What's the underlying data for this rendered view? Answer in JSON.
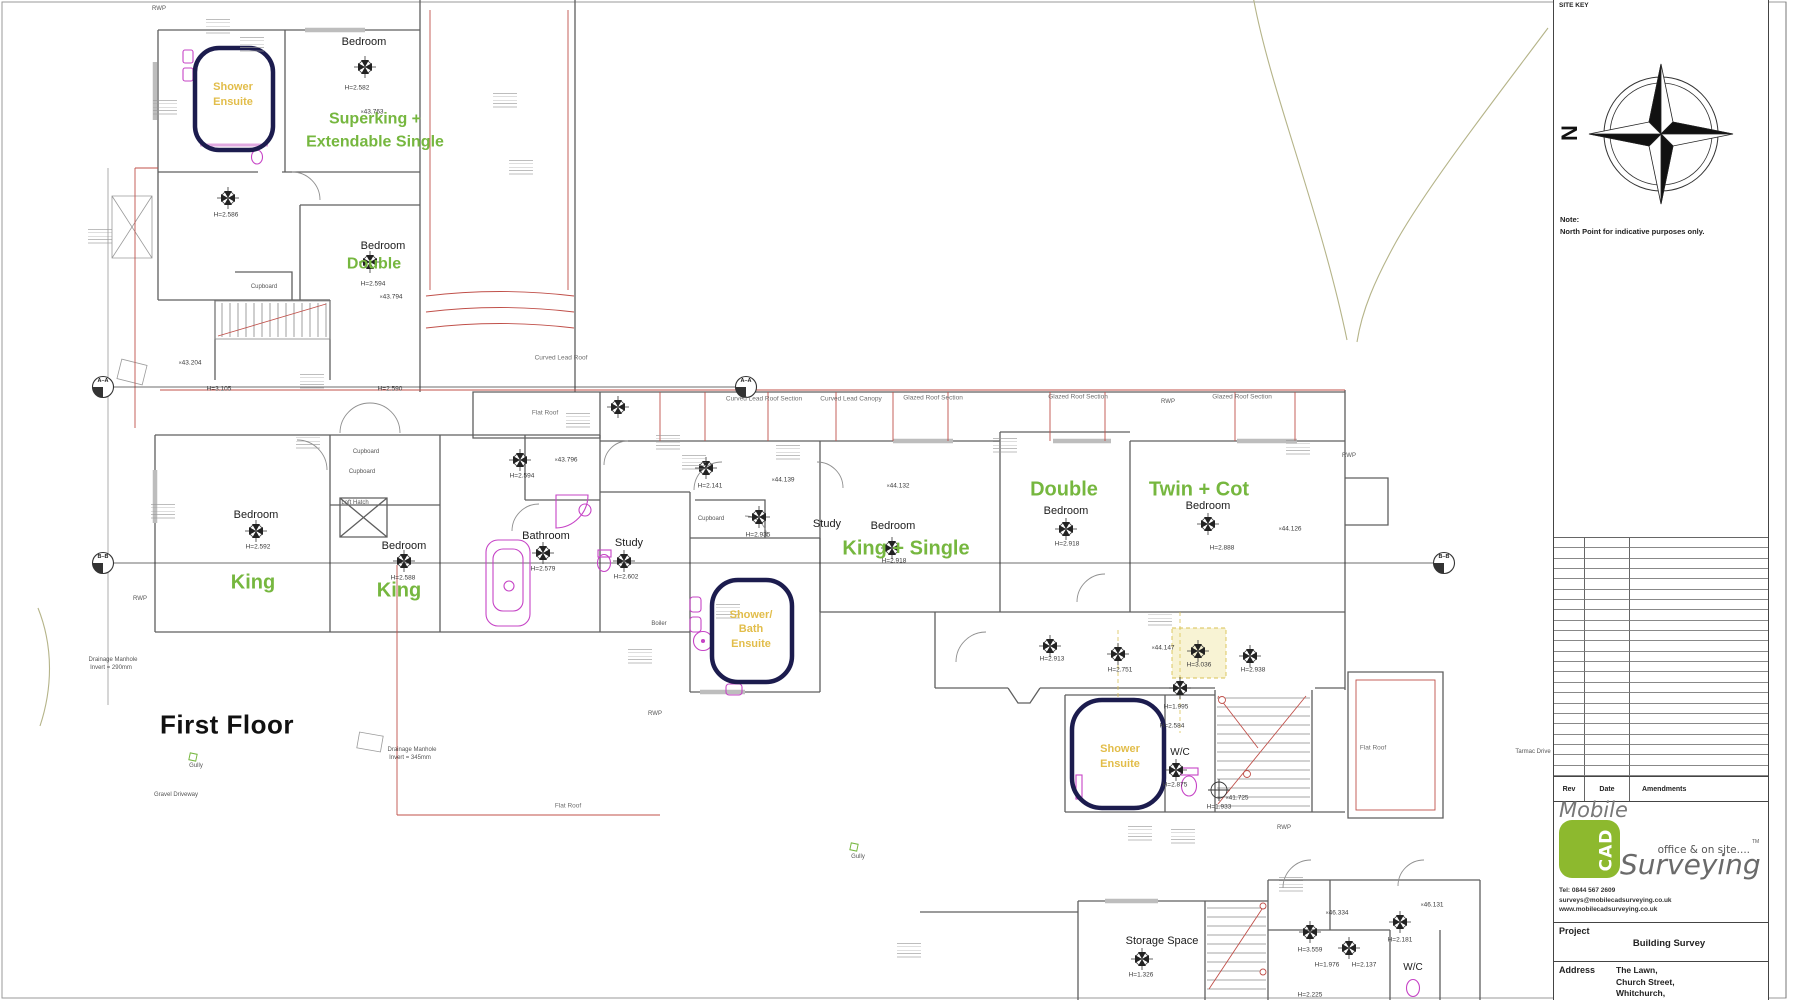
{
  "colors": {
    "room_type_green": "#76b73f",
    "ensuite_yellow": "#e2bd4a",
    "shower_outline_navy": "#1c1c4e",
    "fixture_magenta": "#c644c6",
    "roof_line_red": "#c0504a",
    "logo_green": "#8db92e"
  },
  "sheet": {
    "site_key_label": "SITE KEY",
    "north_letter": "N",
    "note_title": "Note:",
    "note_body": "North Point for indicative purposes only."
  },
  "title_block": {
    "rev_headers": [
      "Rev",
      "Date",
      "Amendments"
    ],
    "empty_rev_rows": 23,
    "logo_mobile": "Mobile",
    "logo_cad": "CAD",
    "logo_surveying": "Surveying",
    "logo_tagline": "office & on site....",
    "logo_tm": "TM",
    "contact_lines": [
      "Tel: 0844 567 2609",
      "surveys@mobilecadsurveying.co.uk",
      "www.mobilecadsurveying.co.uk"
    ],
    "project_label": "Project",
    "project_value": "Building Survey",
    "address_label": "Address",
    "address_lines": [
      "The Lawn,",
      "Church Street,",
      "Whitchurch,"
    ]
  },
  "plan": {
    "floor_title": "First Floor",
    "labels": [
      {
        "t": "Bedroom",
        "x": 364,
        "y": 43,
        "c": "room"
      },
      {
        "t": "Bedroom",
        "x": 383,
        "y": 247,
        "c": "room"
      },
      {
        "t": "Bedroom",
        "x": 256,
        "y": 516,
        "c": "room"
      },
      {
        "t": "Bedroom",
        "x": 404,
        "y": 547,
        "c": "room"
      },
      {
        "t": "Bathroom",
        "x": 546,
        "y": 537,
        "c": "room"
      },
      {
        "t": "Study",
        "x": 629,
        "y": 544,
        "c": "room"
      },
      {
        "t": "Study",
        "x": 827,
        "y": 525,
        "c": "room"
      },
      {
        "t": "Bedroom",
        "x": 893,
        "y": 527,
        "c": "room"
      },
      {
        "t": "Bedroom",
        "x": 1066,
        "y": 512,
        "c": "room"
      },
      {
        "t": "Bedroom",
        "x": 1208,
        "y": 507,
        "c": "room"
      },
      {
        "t": "Storage Space",
        "x": 1162,
        "y": 942,
        "c": "room"
      },
      {
        "t": "W/C",
        "x": 1180,
        "y": 753,
        "c": "wc"
      },
      {
        "t": "W/C",
        "x": 1413,
        "y": 968,
        "c": "wc"
      },
      {
        "t": "Superking +",
        "x": 375,
        "y": 120,
        "c": "g17"
      },
      {
        "t": "Extendable Single",
        "x": 375,
        "y": 143,
        "c": "g17"
      },
      {
        "t": "Double",
        "x": 374,
        "y": 265,
        "c": "g17"
      },
      {
        "t": "King",
        "x": 253,
        "y": 583,
        "c": "g20"
      },
      {
        "t": "King",
        "x": 399,
        "y": 591,
        "c": "g20"
      },
      {
        "t": "King + Single",
        "x": 906,
        "y": 549,
        "c": "g20"
      },
      {
        "t": "Double",
        "x": 1064,
        "y": 490,
        "c": "g20"
      },
      {
        "t": "Twin + Cot",
        "x": 1199,
        "y": 490,
        "c": "g20"
      },
      {
        "t": "Shower",
        "x": 233,
        "y": 88,
        "c": "yel"
      },
      {
        "t": "Ensuite",
        "x": 233,
        "y": 103,
        "c": "yel"
      },
      {
        "t": "Shower/",
        "x": 751,
        "y": 616,
        "c": "yel"
      },
      {
        "t": "Bath",
        "x": 751,
        "y": 630,
        "c": "yel"
      },
      {
        "t": "Ensuite",
        "x": 751,
        "y": 645,
        "c": "yel"
      },
      {
        "t": "Shower",
        "x": 1120,
        "y": 750,
        "c": "yel"
      },
      {
        "t": "Ensuite",
        "x": 1120,
        "y": 765,
        "c": "yel"
      },
      {
        "t": "H=2.582",
        "x": 357,
        "y": 89,
        "c": "meas"
      },
      {
        "t": "H=2.586",
        "x": 226,
        "y": 216,
        "c": "meas"
      },
      {
        "t": "H=2.594",
        "x": 373,
        "y": 285,
        "c": "meas"
      },
      {
        "t": "H=3.105",
        "x": 219,
        "y": 390,
        "c": "meas"
      },
      {
        "t": "H=2.590",
        "x": 390,
        "y": 390,
        "c": "meas"
      },
      {
        "t": "H=2.592",
        "x": 258,
        "y": 548,
        "c": "meas"
      },
      {
        "t": "H=2.588",
        "x": 403,
        "y": 579,
        "c": "meas"
      },
      {
        "t": "H=2.579",
        "x": 543,
        "y": 570,
        "c": "meas"
      },
      {
        "t": "H=2.594",
        "x": 522,
        "y": 477,
        "c": "meas"
      },
      {
        "t": "H=2.602",
        "x": 626,
        "y": 578,
        "c": "meas"
      },
      {
        "t": "H=2.141",
        "x": 710,
        "y": 487,
        "c": "meas"
      },
      {
        "t": "H=2.935",
        "x": 758,
        "y": 536,
        "c": "meas"
      },
      {
        "t": "H=2.918",
        "x": 894,
        "y": 562,
        "c": "meas"
      },
      {
        "t": "H=2.918",
        "x": 1067,
        "y": 545,
        "c": "meas"
      },
      {
        "t": "H=2.888",
        "x": 1222,
        "y": 549,
        "c": "meas"
      },
      {
        "t": "H=2.913",
        "x": 1052,
        "y": 660,
        "c": "meas"
      },
      {
        "t": "H=2.751",
        "x": 1120,
        "y": 671,
        "c": "meas"
      },
      {
        "t": "H=3.036",
        "x": 1199,
        "y": 666,
        "c": "meas"
      },
      {
        "t": "H=2.938",
        "x": 1253,
        "y": 671,
        "c": "meas"
      },
      {
        "t": "H=1.995",
        "x": 1176,
        "y": 708,
        "c": "meas"
      },
      {
        "t": "H=2.584",
        "x": 1172,
        "y": 727,
        "c": "meas"
      },
      {
        "t": "H=2.875",
        "x": 1175,
        "y": 786,
        "c": "meas"
      },
      {
        "t": "H=1.933",
        "x": 1219,
        "y": 808,
        "c": "meas"
      },
      {
        "t": "H=1.326",
        "x": 1141,
        "y": 976,
        "c": "meas"
      },
      {
        "t": "H=3.559",
        "x": 1310,
        "y": 951,
        "c": "meas"
      },
      {
        "t": "H=1.976",
        "x": 1327,
        "y": 966,
        "c": "meas"
      },
      {
        "t": "H=2.137",
        "x": 1364,
        "y": 966,
        "c": "meas"
      },
      {
        "t": "H=2.181",
        "x": 1400,
        "y": 941,
        "c": "meas"
      },
      {
        "t": "H=2.225",
        "x": 1310,
        "y": 996,
        "c": "meas"
      },
      {
        "t": "43.763",
        "x": 372,
        "y": 113,
        "c": "spot"
      },
      {
        "t": "43.794",
        "x": 391,
        "y": 298,
        "c": "spot"
      },
      {
        "t": "43.204",
        "x": 190,
        "y": 364,
        "c": "spot"
      },
      {
        "t": "43.796",
        "x": 566,
        "y": 461,
        "c": "spot"
      },
      {
        "t": "44.139",
        "x": 783,
        "y": 481,
        "c": "spot"
      },
      {
        "t": "44.132",
        "x": 898,
        "y": 487,
        "c": "spot"
      },
      {
        "t": "44.126",
        "x": 1290,
        "y": 530,
        "c": "spot"
      },
      {
        "t": "44.147",
        "x": 1163,
        "y": 649,
        "c": "spot"
      },
      {
        "t": "41.725",
        "x": 1237,
        "y": 799,
        "c": "spot"
      },
      {
        "t": "46.334",
        "x": 1337,
        "y": 914,
        "c": "spot"
      },
      {
        "t": "46.131",
        "x": 1432,
        "y": 906,
        "c": "spot"
      },
      {
        "t": "RWP",
        "x": 159,
        "y": 9,
        "c": "tin"
      },
      {
        "t": "RWP",
        "x": 140,
        "y": 599,
        "c": "tin"
      },
      {
        "t": "RWP",
        "x": 1349,
        "y": 456,
        "c": "tin"
      },
      {
        "t": "RWP",
        "x": 1168,
        "y": 402,
        "c": "tin"
      },
      {
        "t": "RWP",
        "x": 655,
        "y": 714,
        "c": "tin"
      },
      {
        "t": "RWP",
        "x": 1284,
        "y": 828,
        "c": "tin"
      },
      {
        "t": "Gully",
        "x": 196,
        "y": 766,
        "c": "tin"
      },
      {
        "t": "Gully",
        "x": 858,
        "y": 857,
        "c": "tin"
      },
      {
        "t": "Boiler",
        "x": 659,
        "y": 624,
        "c": "tin"
      },
      {
        "t": "Cupboard",
        "x": 264,
        "y": 287,
        "c": "tin"
      },
      {
        "t": "Cupboard",
        "x": 366,
        "y": 452,
        "c": "tin"
      },
      {
        "t": "Cupboard",
        "x": 362,
        "y": 472,
        "c": "tin"
      },
      {
        "t": "Cupboard",
        "x": 711,
        "y": 519,
        "c": "tin"
      },
      {
        "t": "Loft Hatch",
        "x": 355,
        "y": 503,
        "c": "tin"
      },
      {
        "t": "Drainage Manhole",
        "x": 113,
        "y": 660,
        "c": "tin"
      },
      {
        "t": "Invert = 290mm",
        "x": 111,
        "y": 668,
        "c": "tin"
      },
      {
        "t": "Drainage Manhole",
        "x": 412,
        "y": 750,
        "c": "tin"
      },
      {
        "t": "Invert = 345mm",
        "x": 410,
        "y": 758,
        "c": "tin"
      },
      {
        "t": "Gravel Driveway",
        "x": 176,
        "y": 795,
        "c": "tin"
      },
      {
        "t": "Tarmac Drive",
        "x": 1533,
        "y": 752,
        "c": "tin"
      },
      {
        "t": "Curved Lead Roof",
        "x": 561,
        "y": 359,
        "c": "roof"
      },
      {
        "t": "Flat Roof",
        "x": 545,
        "y": 414,
        "c": "roof"
      },
      {
        "t": "Curved Lead Roof Section",
        "x": 764,
        "y": 400,
        "c": "roof"
      },
      {
        "t": "Curved Lead Canopy",
        "x": 851,
        "y": 400,
        "c": "roof"
      },
      {
        "t": "Glazed Roof Section",
        "x": 933,
        "y": 399,
        "c": "roof"
      },
      {
        "t": "Glazed Roof Section",
        "x": 1078,
        "y": 398,
        "c": "roof"
      },
      {
        "t": "Glazed Roof Section",
        "x": 1242,
        "y": 398,
        "c": "roof"
      },
      {
        "t": "Flat Roof",
        "x": 568,
        "y": 807,
        "c": "roof"
      },
      {
        "t": "Flat Roof",
        "x": 1373,
        "y": 749,
        "c": "roof"
      },
      {
        "t": "A–A",
        "x": 103,
        "y": 382,
        "c": "sect"
      },
      {
        "t": "A–A",
        "x": 746,
        "y": 382,
        "c": "sect"
      },
      {
        "t": "B–B",
        "x": 103,
        "y": 558,
        "c": "sect"
      },
      {
        "t": "B–B",
        "x": 1444,
        "y": 558,
        "c": "sect"
      },
      {
        "t": "First Floor",
        "x": 227,
        "y": 725,
        "c": "ttl"
      }
    ]
  }
}
